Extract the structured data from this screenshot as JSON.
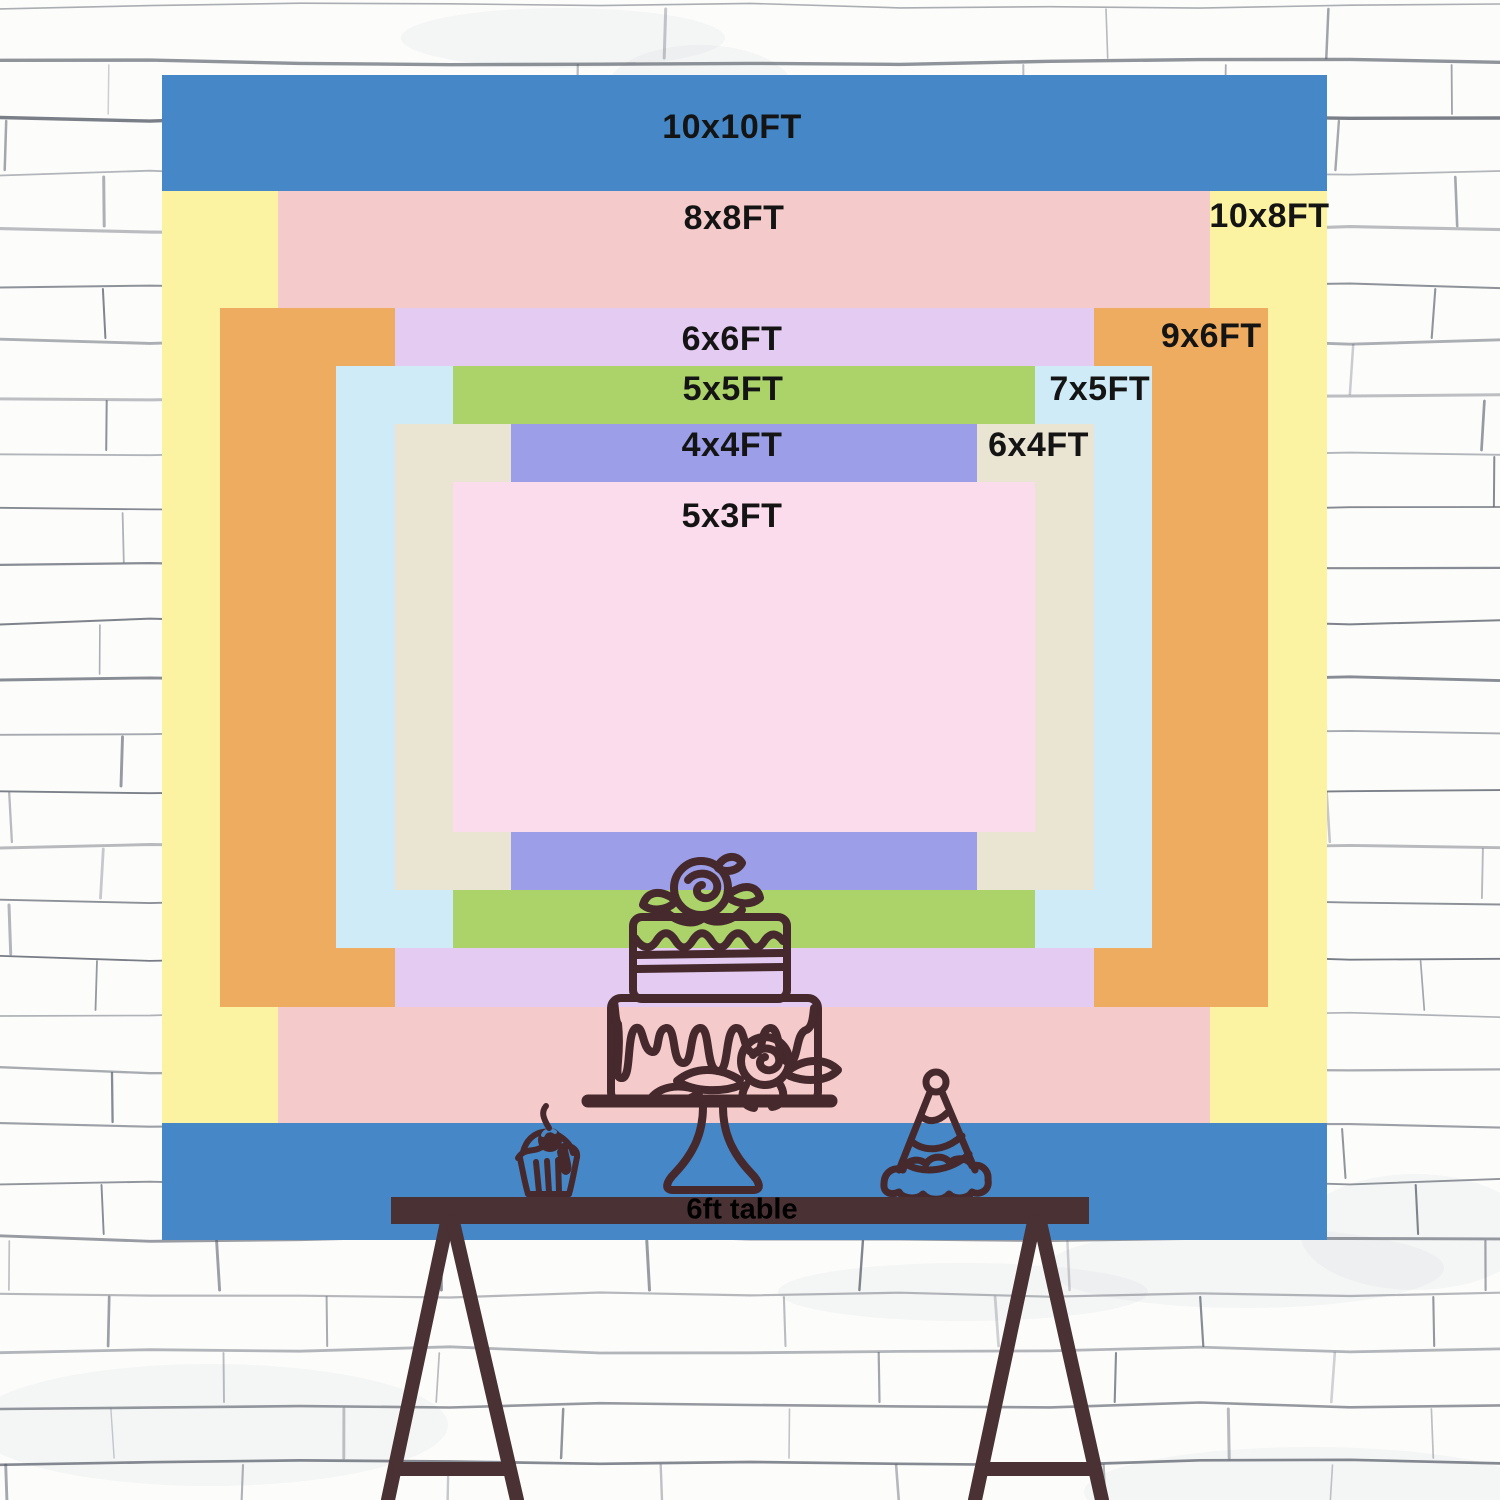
{
  "backdrop": {
    "unit": "FT",
    "label_color": "#141414",
    "sizes": [
      {
        "id": "10x10ft",
        "label": "10x10FT",
        "width_ft": 10,
        "height_ft": 10,
        "color": "#4687c7",
        "label_placement": "top-center"
      },
      {
        "id": "10x8ft",
        "label": "10x8FT",
        "width_ft": 10,
        "height_ft": 8,
        "color": "#fbf3a1",
        "label_placement": "top-right"
      },
      {
        "id": "8x8ft",
        "label": "8x8FT",
        "width_ft": 8,
        "height_ft": 8,
        "color": "#f4caca",
        "label_placement": "top-center"
      },
      {
        "id": "9x6ft",
        "label": "9x6FT",
        "width_ft": 9,
        "height_ft": 6,
        "color": "#eeac61",
        "label_placement": "top-right"
      },
      {
        "id": "6x6ft",
        "label": "6x6FT",
        "width_ft": 6,
        "height_ft": 6,
        "color": "#e4cbf2",
        "label_placement": "top-center"
      },
      {
        "id": "7x5ft",
        "label": "7x5FT",
        "width_ft": 7,
        "height_ft": 5,
        "color": "#cfebf8",
        "label_placement": "top-right"
      },
      {
        "id": "5x5ft",
        "label": "5x5FT",
        "width_ft": 5,
        "height_ft": 5,
        "color": "#acd36a",
        "label_placement": "top-center"
      },
      {
        "id": "6x4ft",
        "label": "6x4FT",
        "width_ft": 6,
        "height_ft": 4,
        "color": "#eae4d3",
        "label_placement": "top-right"
      },
      {
        "id": "4x4ft",
        "label": "4x4FT",
        "width_ft": 4,
        "height_ft": 4,
        "color": "#9c9fe8",
        "label_placement": "top-center"
      },
      {
        "id": "5x3ft",
        "label": "5x3FT",
        "width_ft": 5,
        "height_ft": 3,
        "color": "#fbdcec",
        "label_placement": "top-center"
      }
    ]
  },
  "table": {
    "label": "6ft table",
    "color": "#4a3134",
    "text_color": "#000000"
  },
  "illustrations": {
    "line_color": "#45292d",
    "items": [
      "birthday-cake",
      "cupcake",
      "party-hat"
    ]
  },
  "wall": {
    "base_color": "#fcfcfb",
    "mortar_color": "#4a505c"
  }
}
